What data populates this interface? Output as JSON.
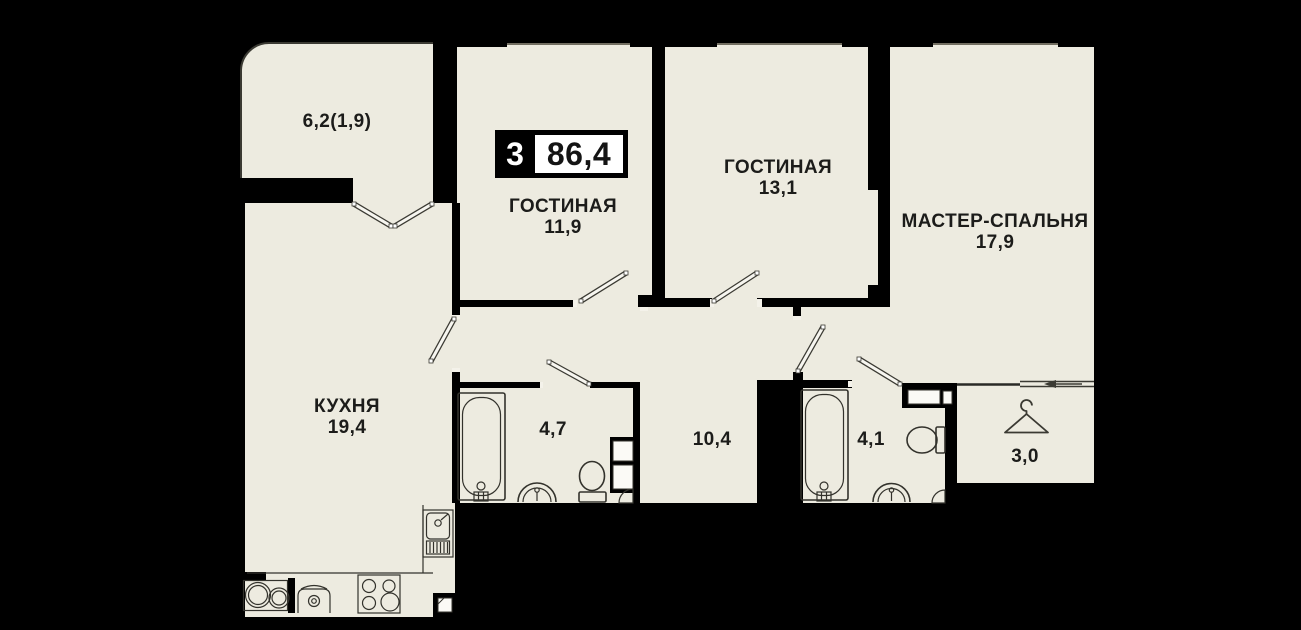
{
  "plan": {
    "badge": {
      "rooms": "3",
      "area": "86,4"
    },
    "rooms": {
      "balcony": {
        "name": "",
        "area": "6,2(1,9)"
      },
      "living1": {
        "name": "ГОСТИНАЯ",
        "area": "11,9"
      },
      "living2": {
        "name": "ГОСТИНАЯ",
        "area": "13,1"
      },
      "master": {
        "name": "МАСТЕР-СПАЛЬНЯ",
        "area": "17,9"
      },
      "kitchen": {
        "name": "КУХНЯ",
        "area": "19,4"
      },
      "bath1": {
        "name": "",
        "area": "4,7"
      },
      "hall": {
        "name": "",
        "area": "10,4"
      },
      "bath2": {
        "name": "",
        "area": "4,1"
      },
      "wardrobe": {
        "name": "",
        "area": "3,0"
      }
    },
    "colors": {
      "floor": "#edebe0",
      "wall": "#000000",
      "line": "#403e36",
      "text": "#1c1c1a",
      "fixture": "#33322c"
    },
    "icons": [
      "hanger-icon",
      "bathtub-icon",
      "toilet-icon",
      "washbasin-icon",
      "kitchen-sink-icon",
      "stove-icon",
      "washing-machine-icon",
      "vent-shaft-icon",
      "sliding-door-arrow-icon",
      "corner-shelf-icon"
    ]
  }
}
